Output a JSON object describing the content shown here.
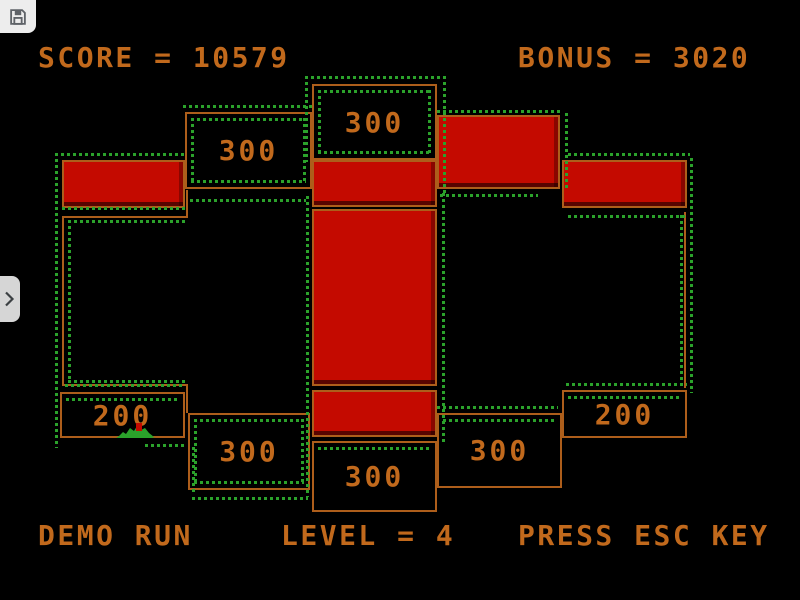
{
  "hud": {
    "score": "SCORE = 10579",
    "bonus": "BONUS = 3020",
    "demo": "DEMO RUN",
    "level": "LEVEL = 4",
    "esc_hint": "PRESS ESC KEY"
  },
  "colors": {
    "background": "#000000",
    "text_orange": "#c1691c",
    "wall_orange": "#ad5e1b",
    "block_red": "#c40a00",
    "trail_green": "#2ba22b"
  },
  "board": {
    "score_boxes": [
      {
        "name": "top-center",
        "value": "300",
        "x": 312,
        "y": 84,
        "w": 125,
        "h": 76,
        "dotted": "inset"
      },
      {
        "name": "top-left",
        "value": "300",
        "x": 185,
        "y": 112,
        "w": 127,
        "h": 77,
        "dotted": "inset"
      },
      {
        "name": "bottom-left",
        "value": "300",
        "x": 188,
        "y": 413,
        "w": 122,
        "h": 77,
        "dotted": "inset"
      },
      {
        "name": "bottom-center",
        "value": "300",
        "x": 312,
        "y": 441,
        "w": 125,
        "h": 71,
        "dotted": "inset-top"
      },
      {
        "name": "bottom-right",
        "value": "300",
        "x": 437,
        "y": 413,
        "w": 125,
        "h": 75,
        "dotted": "inset-top"
      },
      {
        "name": "left",
        "value": "200",
        "x": 60,
        "y": 392,
        "w": 125,
        "h": 46,
        "dotted": "inset-top"
      },
      {
        "name": "right",
        "value": "200",
        "x": 562,
        "y": 390,
        "w": 125,
        "h": 48,
        "dotted": "inset-top"
      }
    ],
    "red_blocks": [
      {
        "name": "top-right",
        "x": 437,
        "y": 115,
        "w": 123,
        "h": 74
      },
      {
        "name": "left-bar",
        "x": 62,
        "y": 160,
        "w": 123,
        "h": 48
      },
      {
        "name": "center-bar",
        "x": 312,
        "y": 160,
        "w": 125,
        "h": 47
      },
      {
        "name": "right-bar",
        "x": 562,
        "y": 160,
        "w": 125,
        "h": 48
      },
      {
        "name": "center-column",
        "x": 312,
        "y": 209,
        "w": 125,
        "h": 177
      },
      {
        "name": "center-lower-bar",
        "x": 312,
        "y": 390,
        "w": 125,
        "h": 47
      }
    ],
    "outlines": [
      {
        "name": "left-region",
        "x": 62,
        "y": 216,
        "w": 126,
        "h": 170,
        "sides": "left,top,bottom"
      },
      {
        "name": "right-region",
        "x": 560,
        "y": 212,
        "w": 126,
        "h": 176,
        "sides": "right"
      },
      {
        "name": "left-top-connector",
        "x": 186,
        "y": 190,
        "w": 2,
        "h": 26,
        "sides": "left"
      },
      {
        "name": "left-bottom-connector",
        "x": 186,
        "y": 386,
        "w": 2,
        "h": 27,
        "sides": "left"
      }
    ],
    "trail_h": [
      [
        305,
        76,
        140
      ],
      [
        183,
        105,
        130
      ],
      [
        437,
        110,
        126
      ],
      [
        55,
        153,
        132
      ],
      [
        568,
        153,
        122
      ],
      [
        62,
        207,
        126
      ],
      [
        190,
        199,
        116
      ],
      [
        440,
        194,
        98
      ],
      [
        568,
        215,
        120
      ],
      [
        68,
        220,
        118
      ],
      [
        68,
        380,
        118
      ],
      [
        65,
        384,
        118
      ],
      [
        145,
        444,
        42
      ],
      [
        192,
        497,
        116
      ],
      [
        437,
        406,
        121
      ],
      [
        566,
        383,
        121
      ]
    ],
    "trail_v": [
      [
        305,
        76,
        86
      ],
      [
        443,
        76,
        118
      ],
      [
        565,
        113,
        75
      ],
      [
        55,
        153,
        295
      ],
      [
        690,
        158,
        235
      ],
      [
        680,
        215,
        170
      ],
      [
        68,
        220,
        162
      ],
      [
        306,
        196,
        301
      ],
      [
        442,
        193,
        249
      ],
      [
        192,
        447,
        48
      ]
    ],
    "creature": {
      "x": 116,
      "y": 422
    }
  },
  "chrome": {
    "save_icon": "floppy-disk",
    "sidebar_toggle_icon": "chevron-right"
  }
}
